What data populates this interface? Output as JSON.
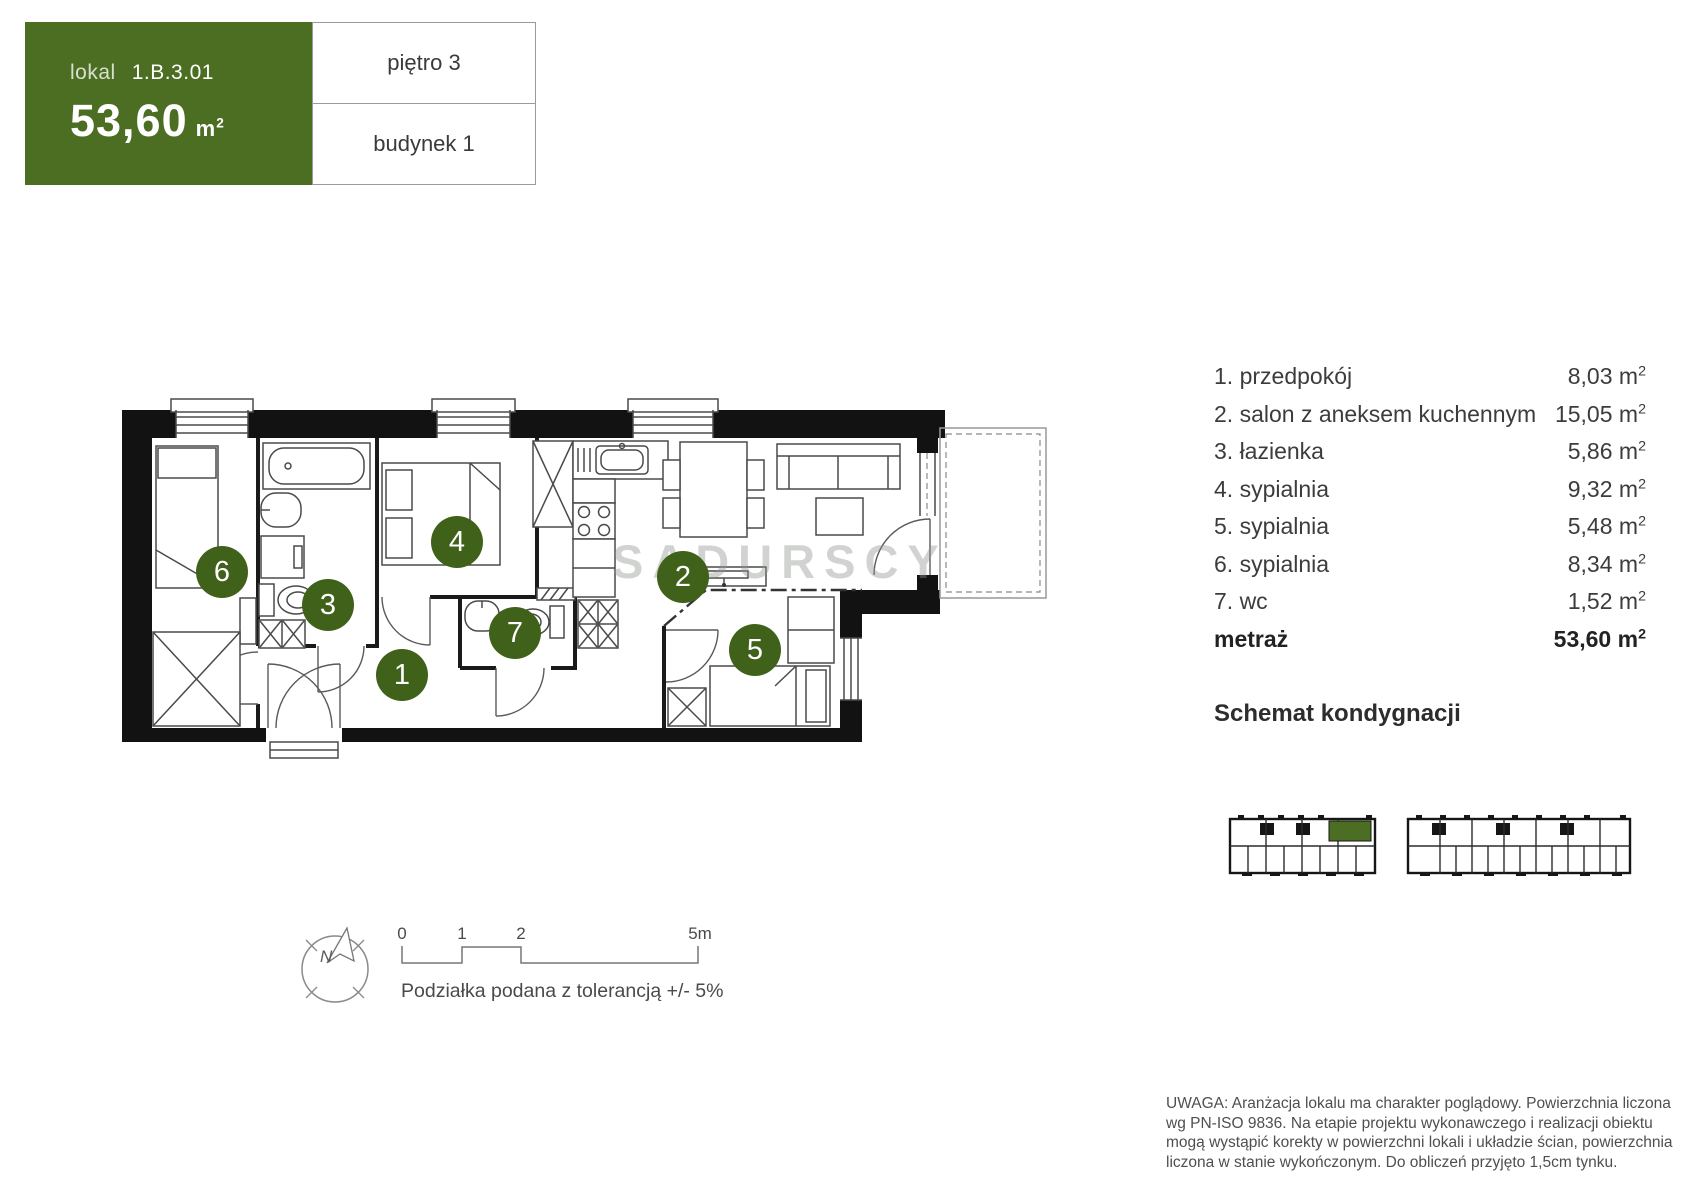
{
  "header": {
    "lokal_label": "lokal",
    "lokal_number": "1.B.3.01",
    "area_value": "53,60",
    "floor_label": "piętro 3",
    "building_label": "budynek 1"
  },
  "units": {
    "symbol": "m",
    "exp": "2"
  },
  "rooms": [
    {
      "num": "1",
      "label": "1. przedpokój",
      "area": "8,03"
    },
    {
      "num": "2",
      "label": "2. salon z aneksem kuchennym",
      "area": "15,05"
    },
    {
      "num": "3",
      "label": "3. łazienka",
      "area": "5,86"
    },
    {
      "num": "4",
      "label": "4. sypialnia",
      "area": "9,32"
    },
    {
      "num": "5",
      "label": "5. sypialnia",
      "area": "5,48"
    },
    {
      "num": "6",
      "label": "6. sypialnia",
      "area": "8,34"
    },
    {
      "num": "7",
      "label": "7. wc",
      "area": "1,52"
    }
  ],
  "totals": {
    "label": "metraż",
    "value": "53,60"
  },
  "schemat_title": "Schemat kondygnacji",
  "compass": {
    "label": "N"
  },
  "scale_bar": {
    "ticks": [
      "0",
      "1",
      "2",
      "5m"
    ],
    "caption": "Podziałka podana z tolerancją +/- 5%"
  },
  "watermark": "SADURSCY",
  "disclaimer": [
    "UWAGA: Aranżacja lokalu ma charakter poglądowy. Powierzchnia liczona",
    "wg PN-ISO 9836. Na etapie projektu wykonawczego i realizacji obiektu",
    "mogą wystąpić korekty w powierzchni lokali i układzie ścian, powierzchnia",
    "liczona w stanie wykończonym. Do obliczeń przyjęto 1,5cm tynku."
  ],
  "colors": {
    "accent_green": "#4c6e22",
    "circle_green": "#40611a",
    "wall_black": "#121212"
  }
}
